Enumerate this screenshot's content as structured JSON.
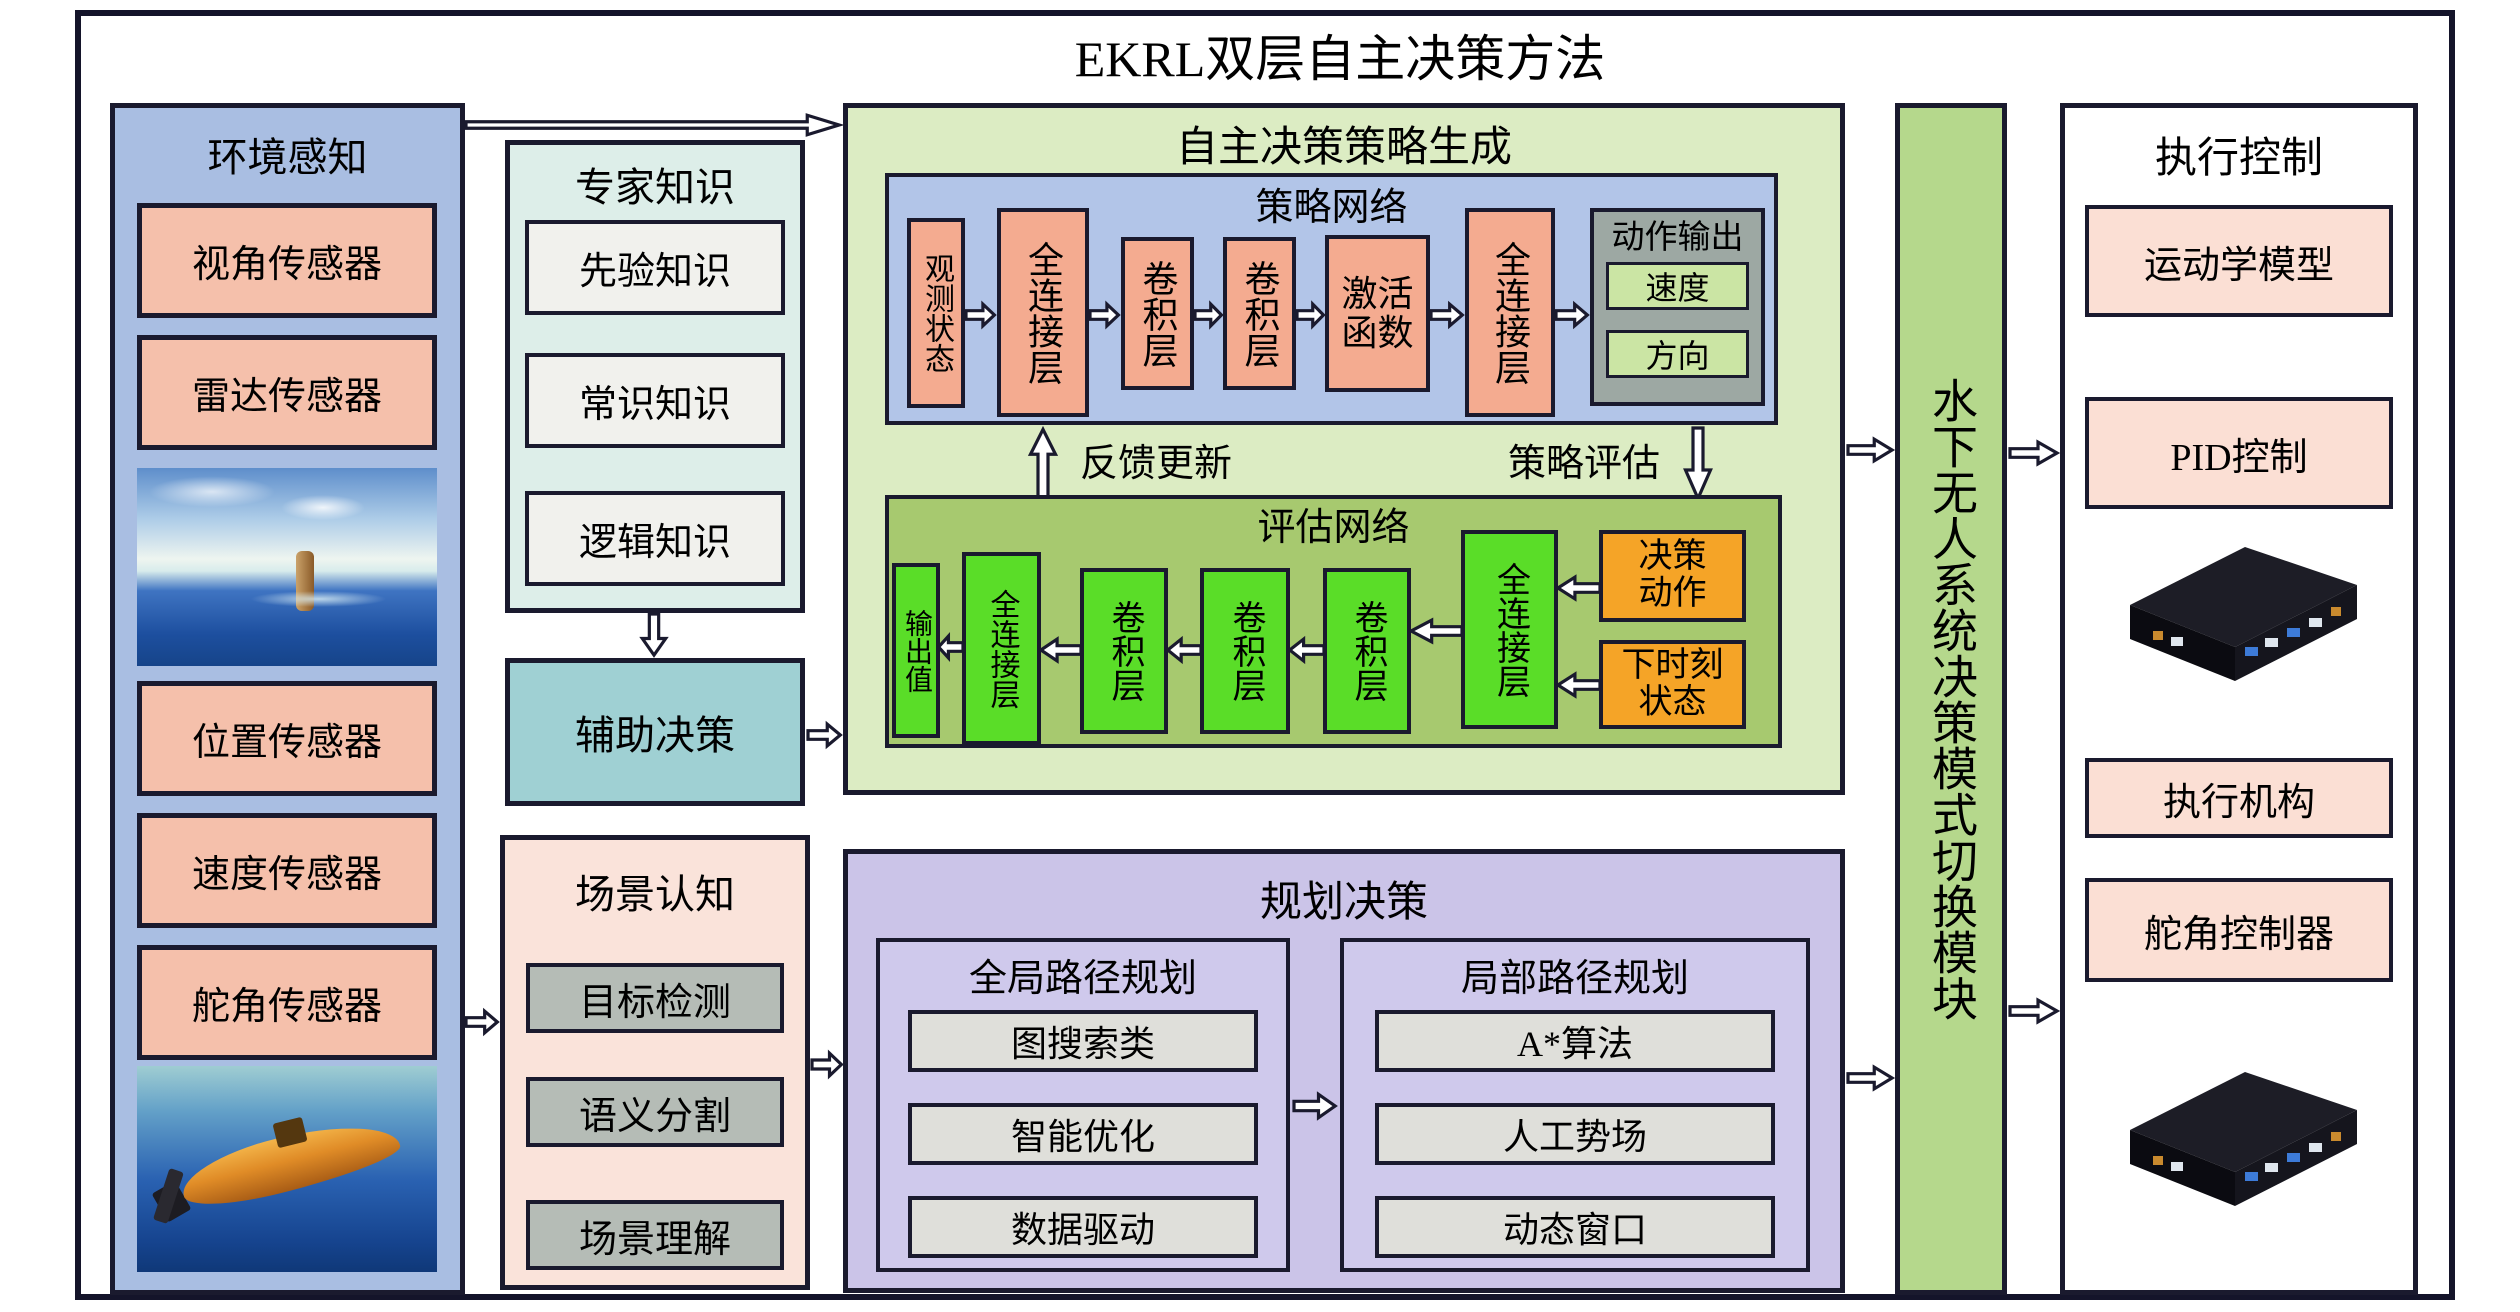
{
  "title": "EKRL双层自主决策方法",
  "perception": {
    "title": "环境感知",
    "sensors": [
      "视角传感器",
      "雷达传感器",
      "位置传感器",
      "速度传感器",
      "舵角传感器"
    ]
  },
  "expert": {
    "title": "专家知识",
    "items": [
      "先验知识",
      "常识知识",
      "逻辑知识"
    ]
  },
  "aux_label": "辅助决策",
  "scene": {
    "title": "场景认知",
    "items": [
      "目标检测",
      "语义分割",
      "场景理解"
    ]
  },
  "strategy": {
    "title": "自主决策策略生成",
    "policy": {
      "title": "策略网络",
      "state": "观测状态",
      "fc1": "全连接层",
      "conv1": "卷积层",
      "conv2": "卷积层",
      "act_line1": "激活",
      "act_line2": "函数",
      "fc2": "全连接层",
      "output_title": "动作输出",
      "speed": "速度",
      "direction": "方向"
    },
    "feedback": "反馈更新",
    "policy_eval": "策略评估",
    "eval": {
      "title": "评估网络",
      "out": "输出值",
      "fc1": "全连接层",
      "conv1": "卷积层",
      "conv2": "卷积层",
      "conv3": "卷积层",
      "fc2": "全连接层",
      "action_line1": "决策",
      "action_line2": "动作",
      "state_line1": "下时刻",
      "state_line2": "状态"
    }
  },
  "planning": {
    "title": "规划决策",
    "global": {
      "title": "全局路径规划",
      "items": [
        "图搜索类",
        "智能优化",
        "数据驱动"
      ]
    },
    "local": {
      "title": "局部路径规划",
      "items": [
        "A*算法",
        "人工势场",
        "动态窗口"
      ]
    }
  },
  "switch_label": "水下无人系统决策模式切换模块",
  "control": {
    "title": "执行控制",
    "items": [
      "运动学模型",
      "PID控制",
      "执行机构",
      "舵角控制器"
    ]
  },
  "images": {
    "ocean": "sea-surface-periscope-photo",
    "submarine": "orange-auv-underwater-photo",
    "hardware": "embedded-computer-photo"
  },
  "colors": {
    "border": "#1a1a2e",
    "perception_blue": "#a9bee2",
    "sensor_salmon": "#f5c0ab",
    "expert_cyan": "#ddeee9",
    "knowledge_white": "#f1f1ed",
    "aux_teal": "#9fd0d3",
    "scene_pink": "#fae3da",
    "scene_grey": "#b5bcb6",
    "strategy_green": "#dcecc3",
    "policy_blue": "#b2c5e8",
    "block_salmon": "#f4ab90",
    "output_grey": "#9da8a3",
    "speed_green": "#cbe5a4",
    "eval_olive": "#a7c96f",
    "eval_green": "#5add28",
    "eval_orange": "#f5a427",
    "planning_purple": "#cbc4e8",
    "planner_grey": "#dfdfda",
    "bar_green": "#b5d88c",
    "control_pink": "#fbdfd4"
  }
}
